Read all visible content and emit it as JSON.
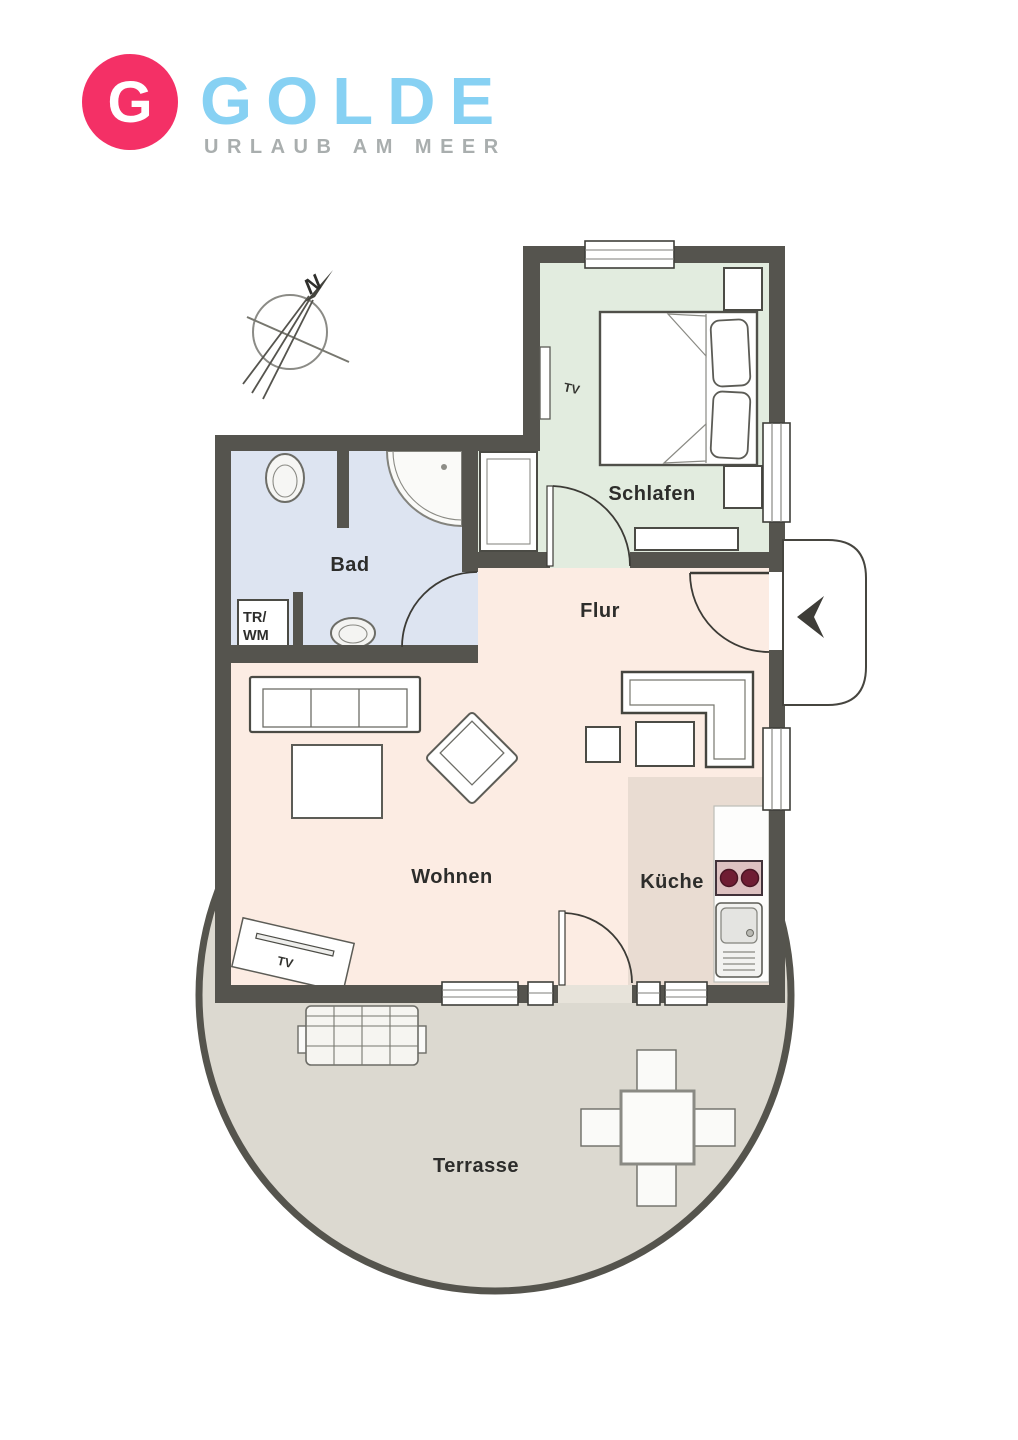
{
  "logo": {
    "letter": "G",
    "brand": "GOLDE",
    "tagline": "URLAUB AM MEER"
  },
  "compass": {
    "north": "N"
  },
  "rooms": {
    "schlafen": {
      "label": "Schlafen"
    },
    "bad": {
      "label": "Bad"
    },
    "flur": {
      "label": "Flur"
    },
    "wohnen": {
      "label": "Wohnen"
    },
    "kueche": {
      "label": "Küche"
    },
    "terrasse": {
      "label": "Terrasse"
    }
  },
  "markers": {
    "tv_bedroom": "TV",
    "tv_living": "TV",
    "washer_line1": "TR/",
    "washer_line2": "WM"
  },
  "colors": {
    "wall": "#55544e",
    "bedroom_floor": "#e2ecdf",
    "bath_floor": "#dde4f1",
    "hall_floor": "#fcece3",
    "kitchen_floor": "#e9dcd2",
    "terrace_floor": "#dcd9d0",
    "logo_pink": "#f43066",
    "logo_blue": "#87d1f3",
    "logo_gray": "#a9aeae",
    "burner": "#6f1d33"
  }
}
